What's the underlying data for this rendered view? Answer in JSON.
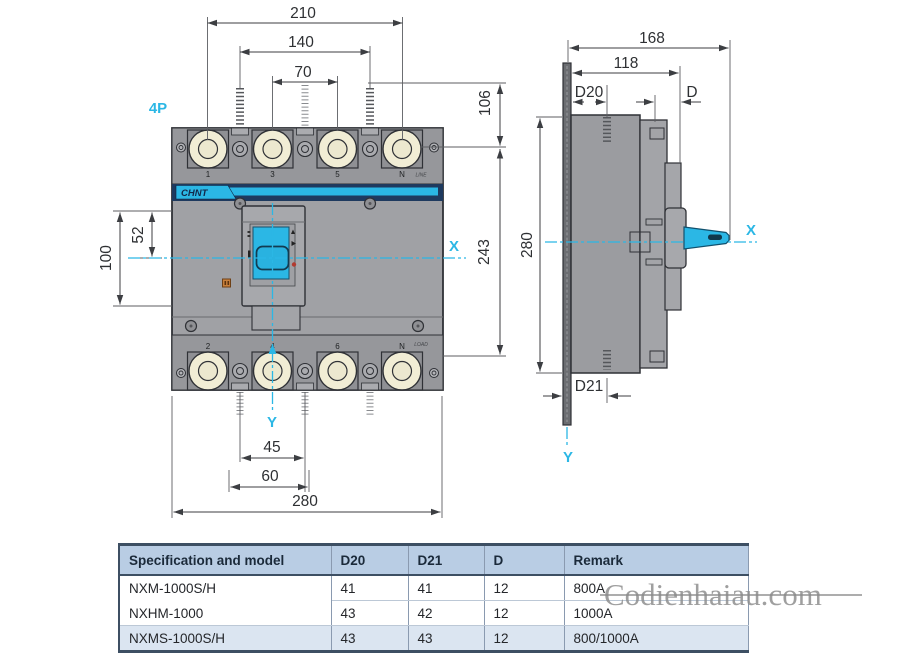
{
  "pole_label": "4P",
  "brand": "CHNT",
  "watermark": "Codienhaiau.com",
  "front_view": {
    "top_terminal_labels": [
      "1",
      "3",
      "5",
      "N"
    ],
    "bottom_terminal_labels": [
      "2",
      "4",
      "6",
      "N"
    ],
    "line_label": "LINE",
    "load_label": "LOAD",
    "axis": {
      "x": "X",
      "y": "Y"
    },
    "dims": {
      "total_width": "210",
      "hole_span": "140",
      "pole_pitch": "70",
      "top_height": "106",
      "body_height": "243",
      "handle_cutout_height": "100",
      "handle_cutout_top": "52",
      "bottom_hole_span": "45",
      "bottom_cutout_width": "60",
      "overall_width": "280"
    }
  },
  "side_view": {
    "axis": {
      "x": "X",
      "y": "Y"
    },
    "dims": {
      "total_depth": "168",
      "body_depth": "118",
      "screw_depth_top": "D20",
      "handle_depth": "D",
      "overall_height": "280",
      "screw_depth_bottom": "D21"
    }
  },
  "table": {
    "headers": [
      "Specification and model",
      "D20",
      "D21",
      "D",
      "Remark"
    ],
    "rows": [
      {
        "model": "NXM-1000S/H",
        "d20": "41",
        "d21": "41",
        "d": "12",
        "remark": "800A"
      },
      {
        "model": "NXHM-1000",
        "d20": "43",
        "d21": "42",
        "d": "12",
        "remark": "1000A"
      },
      {
        "model": "NXMS-1000S/H",
        "d20": "43",
        "d21": "43",
        "d": "12",
        "remark": "800/1000A"
      }
    ]
  },
  "colors": {
    "accent": "#2bb7e5",
    "navy": "#1e3a5f",
    "dimension": "#3c3e42",
    "table_header_bg": "#b9cde4",
    "table_alt_row_bg": "#dbe5f1"
  }
}
